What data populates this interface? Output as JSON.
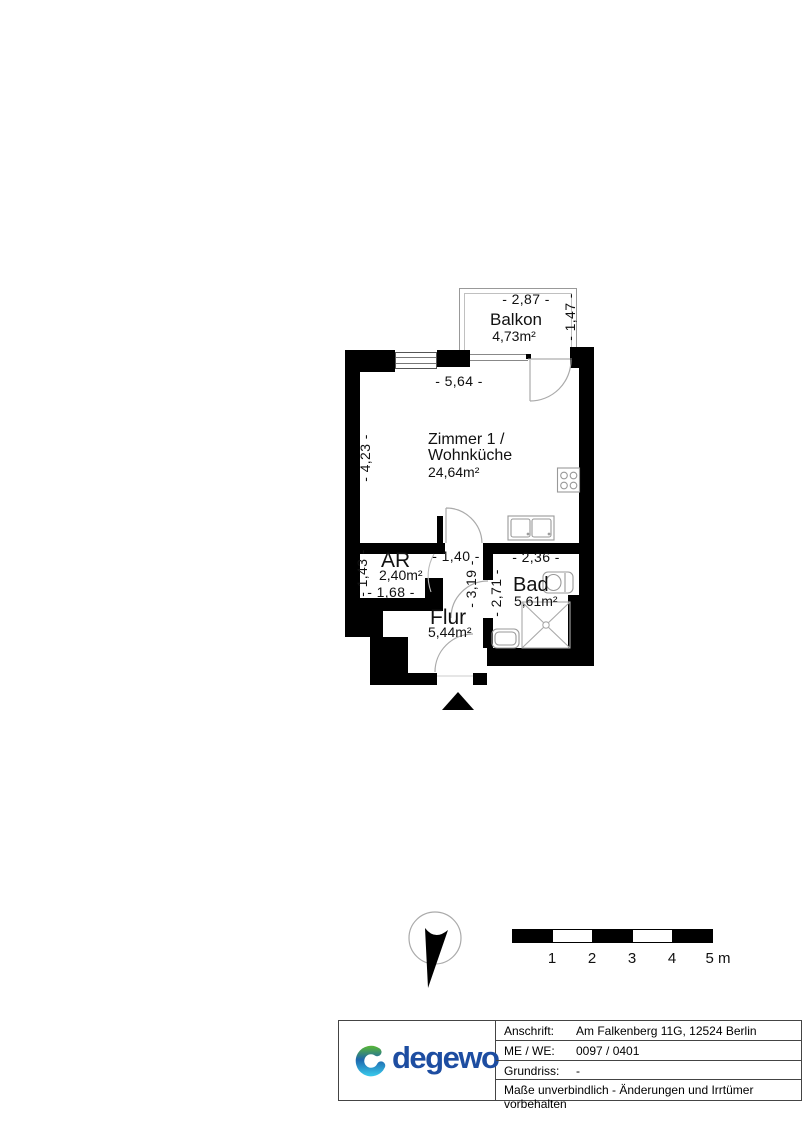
{
  "plan": {
    "balkon": {
      "name": "Balkon",
      "area": "4,73m²",
      "dim_w": "- 2,87 -",
      "dim_h": "- 1,47 -"
    },
    "zimmer": {
      "name_line1": "Zimmer 1 /",
      "name_line2": "Wohnküche",
      "area": "24,64m²",
      "dim_w": "- 5,64 -",
      "dim_h": "- 4,23 -"
    },
    "ar": {
      "name": "AR",
      "area": "2,40m²",
      "dim_h": "- 1,43 -",
      "dim_w": "- 1,68 -"
    },
    "flur": {
      "name": "Flur",
      "area": "5,44m²",
      "dim_top": "- 1,40 -",
      "dim_h": "- 3,19 -"
    },
    "bad": {
      "name": "Bad",
      "area": "5,61m²",
      "dim_w": "- 2,36 -",
      "dim_h": "- 2,71 -"
    }
  },
  "scale_bar": {
    "labels": [
      "1",
      "2",
      "3",
      "4",
      "5 m"
    ]
  },
  "title_block": {
    "logo_text": "degewo",
    "rows": [
      {
        "label": "Anschrift:",
        "value": "Am Falkenberg 11G, 12524 Berlin"
      },
      {
        "label": "ME / WE:",
        "value": "0097 / 0401"
      },
      {
        "label": "Grundriss:",
        "value": "-"
      }
    ],
    "disclaimer": "Maße unverbindlich - Änderungen und Irrtümer vorbehalten"
  },
  "colors": {
    "wall": "#000000",
    "fixture_line": "#999999",
    "logo_blue": "#1d4da1",
    "logo_green": "#55b13c",
    "logo_cyan": "#38c4e8"
  }
}
